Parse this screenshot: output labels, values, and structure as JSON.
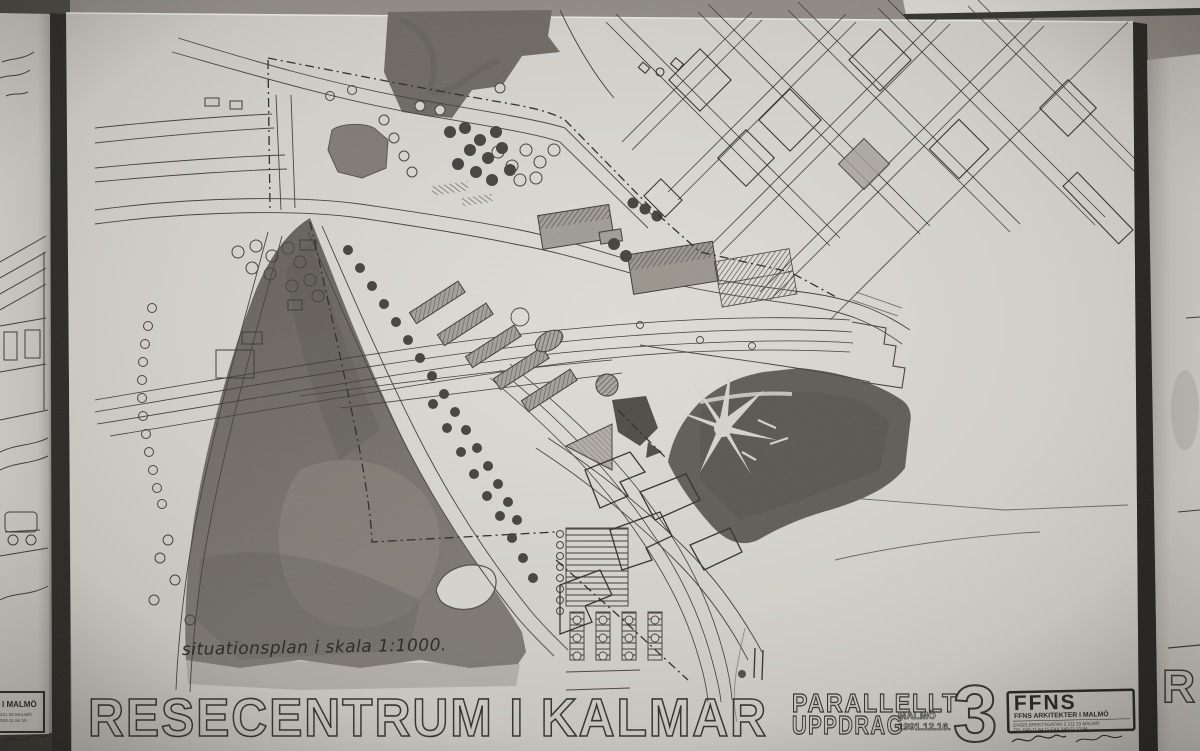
{
  "main_board": {
    "handwritten_note": "situationsplan i skala 1:1000.",
    "title": "RESECENTRUM I KALMAR",
    "subtitle_line1": "PARALLELLT",
    "subtitle_line2": "UPPDRAG",
    "subtitle_place": "MALMÖ",
    "subtitle_date": "1991.12.16.",
    "board_number": "3",
    "logo": {
      "name": "FFNS",
      "firm": "FFNS ARKITEKTER I MALMÖ",
      "address_line1": "ENGELBREKTSGATAN 2   211 33 MALMÖ",
      "address_line2": "TEL 040-11 84 15   FAX 040-11 13 84",
      "signature_icons": [
        "handwritten-signature",
        "handwritten-signature"
      ]
    }
  },
  "left_board": {
    "logo_partial": "I MALMÖ",
    "address_partial_1": "211 33 MALMÖ",
    "address_partial_2": "040-11 84 15"
  },
  "right_board": {
    "title_partial": "RE"
  },
  "colors": {
    "paper": "#d6d3cd",
    "wall": "#8f8b84",
    "ink": "#34322e",
    "wash_dark": "#6b6761",
    "wash_park_right": "#615d57",
    "seam": "#26251f"
  }
}
